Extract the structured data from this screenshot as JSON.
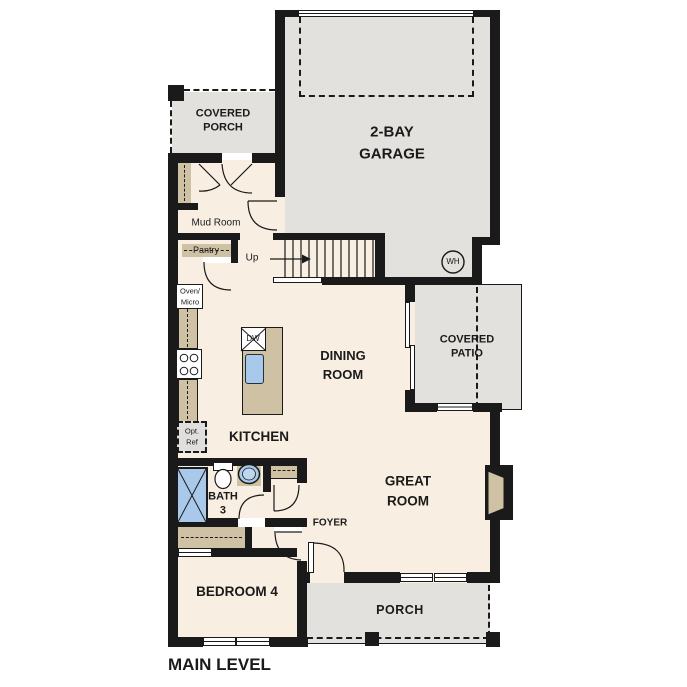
{
  "title": "MAIN LEVEL",
  "rooms": {
    "covered_porch": {
      "line1": "COVERED",
      "line2": "PORCH"
    },
    "garage": {
      "line1": "2-BAY",
      "line2": "GARAGE"
    },
    "mud_room": {
      "label": "Mud Room"
    },
    "pantry": {
      "label": "Pantry"
    },
    "kitchen": {
      "label": "KITCHEN"
    },
    "dining_room": {
      "line1": "DINING",
      "line2": "ROOM"
    },
    "covered_patio": {
      "line1": "COVERED",
      "line2": "PATIO"
    },
    "great_room": {
      "line1": "GREAT",
      "line2": "ROOM"
    },
    "foyer": {
      "label": "FOYER"
    },
    "bath_3": {
      "line1": "BATH",
      "line2": "3"
    },
    "bedroom_4": {
      "label": "BEDROOM 4"
    },
    "porch": {
      "label": "PORCH"
    }
  },
  "fixtures": {
    "stairs_direction": "Up",
    "oven_micro": {
      "line1": "Oven/",
      "line2": "Micro"
    },
    "optional_refrigerator": {
      "line1": "Opt.",
      "line2": "Ref"
    },
    "dishwasher": "DW",
    "water_heater": "WH"
  },
  "colors": {
    "floor": "#f8efe2",
    "outdoor": "#e2e1de",
    "wall": "#1a1a1a",
    "cabinet": "#cfc1a4",
    "plumbing": "#a9c9ea"
  }
}
